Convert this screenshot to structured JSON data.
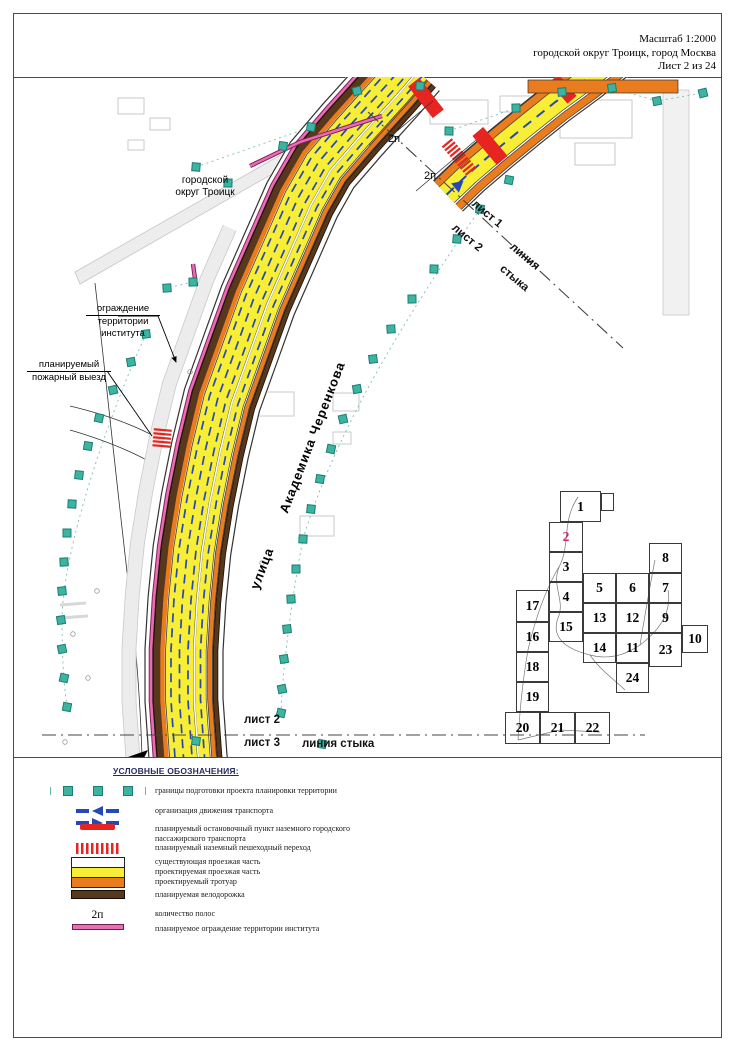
{
  "header": {
    "scale": "Масштаб 1:2000",
    "location": "городской округ Троицк, город Москва",
    "sheet": "Лист 2 из 24"
  },
  "map": {
    "district_label": "городской\nокруг Троицк",
    "street_word1": "улица",
    "street_word2": "Академика Черенкова",
    "fence_label": [
      "ограждение",
      "территории",
      "института"
    ],
    "fire_exit_label": [
      "планируемый",
      "пожарный выезд"
    ],
    "lane_labels": [
      {
        "text": "2п",
        "x": 388,
        "y": 133
      },
      {
        "text": "2п",
        "x": 424,
        "y": 170
      }
    ],
    "seam_top": {
      "sheet_above": "лист 1",
      "sheet_below": "лист 2",
      "word1": "линия",
      "word2": "стыка",
      "line": [
        368,
        112,
        623,
        348
      ]
    },
    "seam_bottom": {
      "sheet_above": "лист 2",
      "sheet_below": "лист 3",
      "label": "линия стыка",
      "line": [
        42,
        735,
        645,
        735
      ]
    },
    "roads": {
      "main": {
        "centerline": [
          [
            410,
            65
          ],
          [
            390,
            88
          ],
          [
            352,
            130
          ],
          [
            322,
            165
          ],
          [
            302,
            200
          ],
          [
            280,
            250
          ],
          [
            258,
            300
          ],
          [
            240,
            350
          ],
          [
            222,
            400
          ],
          [
            210,
            450
          ],
          [
            200,
            500
          ],
          [
            192,
            550
          ],
          [
            187,
            600
          ],
          [
            184,
            650
          ],
          [
            184,
            700
          ],
          [
            188,
            757
          ],
          [
            190,
            775
          ]
        ],
        "stripes": [
          {
            "o": -55,
            "w": 14,
            "c": "#ececec",
            "f": 0.3
          },
          {
            "o": -62,
            "w": 0.8,
            "c": "#c9c9c9",
            "f": 0.3
          },
          {
            "o": -48,
            "w": 0.8,
            "c": "#c9c9c9",
            "f": 0.3
          },
          {
            "o": 0,
            "w": 80,
            "c": "#ffffff"
          },
          {
            "o": -39,
            "w": 1.2,
            "c": "#333333"
          },
          {
            "o": 39,
            "w": 1.2,
            "c": "#333333"
          },
          {
            "o": 22,
            "w": 16,
            "c": "#e87c1e",
            "t": 0.12
          },
          {
            "o": -33,
            "w": 4.6,
            "c": "#7c2356"
          },
          {
            "o": -33,
            "w": 2.6,
            "c": "#ea6cb4"
          },
          {
            "o": -27,
            "w": 9,
            "c": "#1a1208"
          },
          {
            "o": -27,
            "w": 6.6,
            "c": "#57381c"
          },
          {
            "o": -21.5,
            "w": 4.5,
            "c": "#e87c1e"
          },
          {
            "o": -4.5,
            "w": 28.6,
            "c": "#3a3a3a"
          },
          {
            "o": -4.5,
            "w": 27,
            "c": "#f8ee35"
          },
          {
            "o": 16.5,
            "w": 12,
            "c": "#3a3a3a"
          },
          {
            "o": 16.5,
            "w": 10.6,
            "c": "#f8ee35"
          },
          {
            "o": 10.2,
            "w": 1.6,
            "c": "#ffffff"
          },
          {
            "o": -13,
            "w": 1.7,
            "c": "#2547b8",
            "dash": "9,6"
          },
          {
            "o": -4.5,
            "w": 1.7,
            "c": "#2547b8",
            "dash": "9,6"
          },
          {
            "o": 4,
            "w": 1.7,
            "c": "#2547b8",
            "dash": "9,6"
          },
          {
            "o": 16.5,
            "w": 1.7,
            "c": "#2547b8",
            "dash": "9,6"
          },
          {
            "o": 26,
            "w": 5.5,
            "c": "#3a3a3a"
          },
          {
            "o": 26,
            "w": 4,
            "c": "#e87c1e"
          },
          {
            "o": 31.5,
            "w": 5.5,
            "c": "#1a1208"
          },
          {
            "o": 31.5,
            "w": 3.8,
            "c": "#57381c"
          }
        ]
      },
      "upper": {
        "centerline": [
          [
            448,
            196
          ],
          [
            470,
            175
          ],
          [
            498,
            151
          ],
          [
            526,
            128
          ],
          [
            556,
            104
          ],
          [
            586,
            82
          ],
          [
            614,
            60
          ]
        ],
        "stripes": [
          {
            "o": 0,
            "w": 44,
            "c": "#ffffff"
          },
          {
            "o": -21,
            "w": 1.2,
            "c": "#333333"
          },
          {
            "o": 21,
            "w": 1.2,
            "c": "#333333"
          },
          {
            "o": -15,
            "w": 8.4,
            "c": "#3a3a3a"
          },
          {
            "o": -15,
            "w": 7,
            "c": "#e87c1e"
          },
          {
            "o": 2,
            "w": 23,
            "c": "#3a3a3a"
          },
          {
            "o": 2,
            "w": 21.6,
            "c": "#f8ee35"
          },
          {
            "o": 2,
            "w": 2,
            "c": "#2547b8",
            "dash": "10,7"
          },
          {
            "o": 16.5,
            "w": 8.4,
            "c": "#3a3a3a"
          },
          {
            "o": 16.5,
            "w": 7,
            "c": "#e87c1e"
          }
        ]
      }
    },
    "markers": [
      [
        357,
        91
      ],
      [
        311,
        127
      ],
      [
        283,
        146
      ],
      [
        196,
        167
      ],
      [
        228,
        183
      ],
      [
        193,
        282
      ],
      [
        167,
        288
      ],
      [
        146,
        334
      ],
      [
        131,
        362
      ],
      [
        113,
        390
      ],
      [
        99,
        418
      ],
      [
        88,
        446
      ],
      [
        79,
        475
      ],
      [
        72,
        504
      ],
      [
        67,
        533
      ],
      [
        64,
        562
      ],
      [
        62,
        591
      ],
      [
        61,
        620
      ],
      [
        62,
        649
      ],
      [
        64,
        678
      ],
      [
        67,
        707
      ],
      [
        196,
        741
      ],
      [
        420,
        86
      ],
      [
        449,
        131
      ],
      [
        516,
        108
      ],
      [
        562,
        92
      ],
      [
        612,
        88
      ],
      [
        657,
        101
      ],
      [
        703,
        93
      ],
      [
        509,
        180
      ],
      [
        480,
        209
      ],
      [
        457,
        239
      ],
      [
        434,
        269
      ],
      [
        412,
        299
      ],
      [
        391,
        329
      ],
      [
        373,
        359
      ],
      [
        357,
        389
      ],
      [
        343,
        419
      ],
      [
        331,
        449
      ],
      [
        320,
        479
      ],
      [
        311,
        509
      ],
      [
        303,
        539
      ],
      [
        296,
        569
      ],
      [
        291,
        599
      ],
      [
        287,
        629
      ],
      [
        284,
        659
      ],
      [
        282,
        689
      ],
      [
        281,
        713
      ],
      [
        322,
        744
      ]
    ],
    "stops": [
      [
        426,
        98,
        14,
        40,
        -38
      ],
      [
        490,
        146,
        14,
        38,
        -40
      ],
      [
        563,
        89,
        12,
        28,
        -40
      ]
    ],
    "crossings": [
      [
        459,
        157,
        36,
        13,
        50
      ],
      [
        162,
        439,
        18,
        18,
        95
      ]
    ],
    "arrows": [
      [
        570,
        87,
        -40
      ],
      [
        455,
        188,
        -40
      ]
    ],
    "fence_lines": [
      [
        [
          382,
          116
        ],
        [
          300,
          142
        ],
        [
          250,
          166
        ]
      ],
      [
        [
          193,
          264
        ],
        [
          196,
          286
        ]
      ]
    ],
    "section_lines": [
      [
        372,
        152,
        433,
        101
      ],
      [
        416,
        191,
        476,
        140
      ]
    ]
  },
  "sheet_index": {
    "cells": [
      {
        "n": "1",
        "x": 560,
        "y": 491,
        "w": 41,
        "h": 31
      },
      {
        "n": "2",
        "x": 549,
        "y": 522,
        "w": 34,
        "h": 30,
        "current": true
      },
      {
        "n": "3",
        "x": 549,
        "y": 552,
        "w": 34,
        "h": 30
      },
      {
        "n": "4",
        "x": 549,
        "y": 582,
        "w": 34,
        "h": 30
      },
      {
        "n": "5",
        "x": 583,
        "y": 573,
        "w": 33,
        "h": 30
      },
      {
        "n": "6",
        "x": 616,
        "y": 573,
        "w": 33,
        "h": 30
      },
      {
        "n": "7",
        "x": 649,
        "y": 573,
        "w": 33,
        "h": 30
      },
      {
        "n": "8",
        "x": 649,
        "y": 543,
        "w": 33,
        "h": 30
      },
      {
        "n": "9",
        "x": 649,
        "y": 603,
        "w": 33,
        "h": 30
      },
      {
        "n": "10",
        "x": 682,
        "y": 625,
        "w": 26,
        "h": 28
      },
      {
        "n": "11",
        "x": 616,
        "y": 633,
        "w": 33,
        "h": 30
      },
      {
        "n": "12",
        "x": 616,
        "y": 603,
        "w": 33,
        "h": 30
      },
      {
        "n": "13",
        "x": 583,
        "y": 603,
        "w": 33,
        "h": 30
      },
      {
        "n": "14",
        "x": 583,
        "y": 633,
        "w": 33,
        "h": 30
      },
      {
        "n": "15",
        "x": 549,
        "y": 612,
        "w": 34,
        "h": 30
      },
      {
        "n": "16",
        "x": 516,
        "y": 622,
        "w": 33,
        "h": 30
      },
      {
        "n": "17",
        "x": 516,
        "y": 590,
        "w": 33,
        "h": 32
      },
      {
        "n": "18",
        "x": 516,
        "y": 652,
        "w": 33,
        "h": 30
      },
      {
        "n": "19",
        "x": 516,
        "y": 682,
        "w": 33,
        "h": 30
      },
      {
        "n": "20",
        "x": 505,
        "y": 712,
        "w": 35,
        "h": 32
      },
      {
        "n": "21",
        "x": 540,
        "y": 712,
        "w": 35,
        "h": 32
      },
      {
        "n": "22",
        "x": 575,
        "y": 712,
        "w": 35,
        "h": 32
      },
      {
        "n": "23",
        "x": 649,
        "y": 633,
        "w": 33,
        "h": 34
      },
      {
        "n": "24",
        "x": 616,
        "y": 663,
        "w": 33,
        "h": 30
      }
    ]
  },
  "legend": {
    "title": "УСЛОВНЫЕ ОБОЗНАЧЕНИЯ:",
    "items": [
      {
        "type": "boundary",
        "y": 26,
        "label": "границы подготовки проекта планировки территории"
      },
      {
        "type": "traffic",
        "y": 46,
        "label": "организация движения транспорта"
      },
      {
        "type": "stop",
        "y": 64,
        "label": "планируемый остановочный пункт наземного городского",
        "label2": "пассажирского транспорта"
      },
      {
        "type": "crosswalk",
        "y": 83,
        "label": "планируемый наземный пешеходный переход"
      },
      {
        "type": "road_existing",
        "y": 97,
        "label": "существующая проезжая часть"
      },
      {
        "type": "road_planned",
        "y": 107,
        "label": "проектируемая проезжая часть"
      },
      {
        "type": "sidewalk",
        "y": 117,
        "label": "проектируемый тротуар"
      },
      {
        "type": "bike",
        "y": 130,
        "label": "планируемая велодорожка"
      },
      {
        "type": "lanes",
        "y": 149,
        "symbol_text": "2п",
        "label": "количество полос"
      },
      {
        "type": "fence",
        "y": 164,
        "label": "планируемое ограждение территории института"
      }
    ]
  },
  "colors": {
    "teal": "#3db3a2",
    "teal_border": "#1b7f6f",
    "yellow": "#f8ee35",
    "orange": "#e87c1e",
    "brown": "#57381c",
    "pink": "#ea6cb4",
    "blue": "#2547b8",
    "red": "#e62420",
    "index_current": "#d4256e",
    "seam": "#444444"
  }
}
